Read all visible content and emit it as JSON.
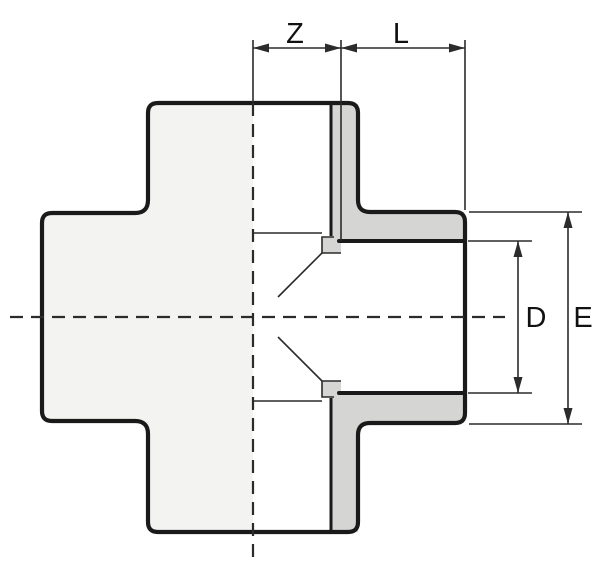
{
  "drawing": {
    "labels": {
      "z": "Z",
      "l": "L",
      "d": "D",
      "e": "E"
    }
  },
  "colors": {
    "background": "#ffffff",
    "body-fill": "#f3f3f1",
    "section-fill": "#ffffff",
    "wall-fill": "#d5d5d3",
    "outline": "#1a1a1a",
    "thin-line": "#2b2b2b",
    "label": "#111111"
  }
}
